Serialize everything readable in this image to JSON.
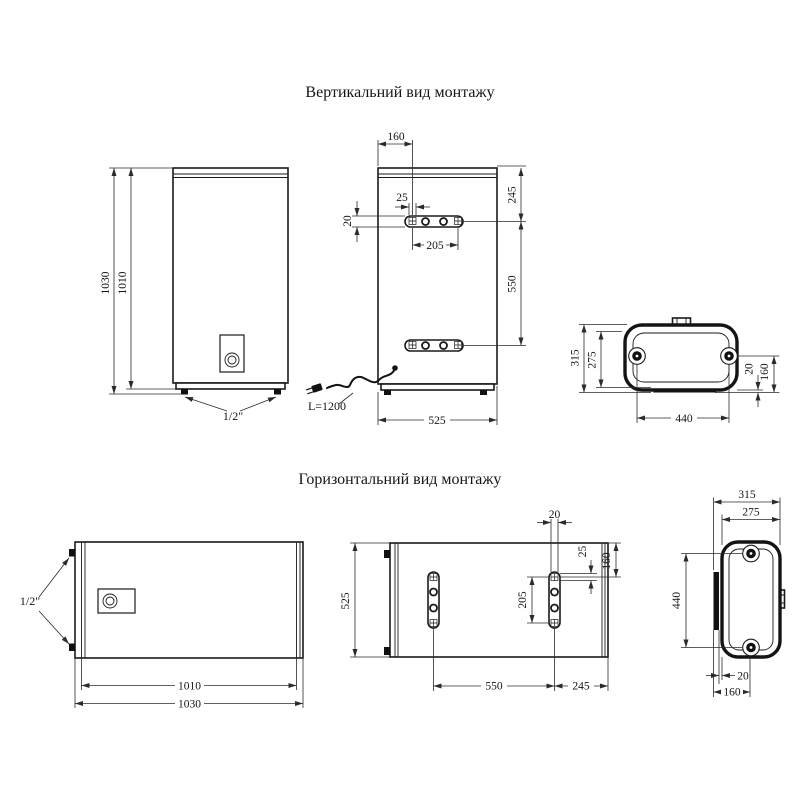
{
  "vertical": {
    "title": "Вертикальний вид монтажу",
    "front": {
      "height_outer": "1030",
      "height_inner": "1010",
      "pipe_size": "1/2\""
    },
    "back": {
      "top_offset": "160",
      "slot_width": "25",
      "plate_height": "20",
      "hole_spacing": "205",
      "top_to_bracket": "245",
      "bracket_spacing": "550",
      "body_width": "525",
      "cord_length": "L=1200"
    },
    "top": {
      "depth_outer": "315",
      "depth_inner": "275",
      "mount_width": "440",
      "wall_gap": "20",
      "hole_to_wall": "160"
    }
  },
  "horizontal": {
    "title": "Горизонтальний вид монтажу",
    "front": {
      "pipe_size": "1/2\"",
      "width_inner": "1010",
      "width_outer": "1030"
    },
    "back": {
      "body_height": "525",
      "slot_width": "20",
      "slot_height": "25",
      "edge_to_hole": "160",
      "hole_spacing": "205",
      "bracket_spacing": "550",
      "bracket_to_edge": "245"
    },
    "side": {
      "depth_outer": "315",
      "depth_inner": "275",
      "mount_height": "440",
      "wall_gap": "20",
      "hole_to_wall": "160"
    }
  }
}
